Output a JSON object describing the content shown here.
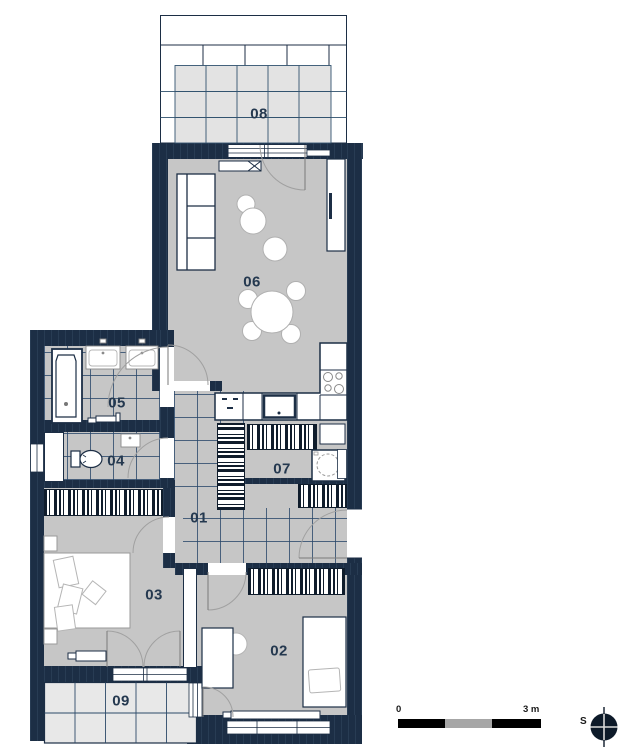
{
  "title": "apartment-floor-plan",
  "rooms": [
    {
      "id": "08",
      "label": "08"
    },
    {
      "id": "06",
      "label": "06"
    },
    {
      "id": "05",
      "label": "05"
    },
    {
      "id": "04",
      "label": "04"
    },
    {
      "id": "07",
      "label": "07"
    },
    {
      "id": "01",
      "label": "01"
    },
    {
      "id": "03",
      "label": "03"
    },
    {
      "id": "02",
      "label": "02"
    },
    {
      "id": "09",
      "label": "09"
    }
  ],
  "scale_bar": {
    "start_label": "0",
    "end_label": "3 m"
  },
  "compass": {
    "direction_label": "S"
  },
  "colors": {
    "wall": "#1c2e45",
    "floor": "#c6c6c6",
    "tile_line": "#2d4a69",
    "terrace_tile": "#e3e3e3",
    "balcony_tile": "#e8e8e8",
    "label_text": "#24384f"
  }
}
